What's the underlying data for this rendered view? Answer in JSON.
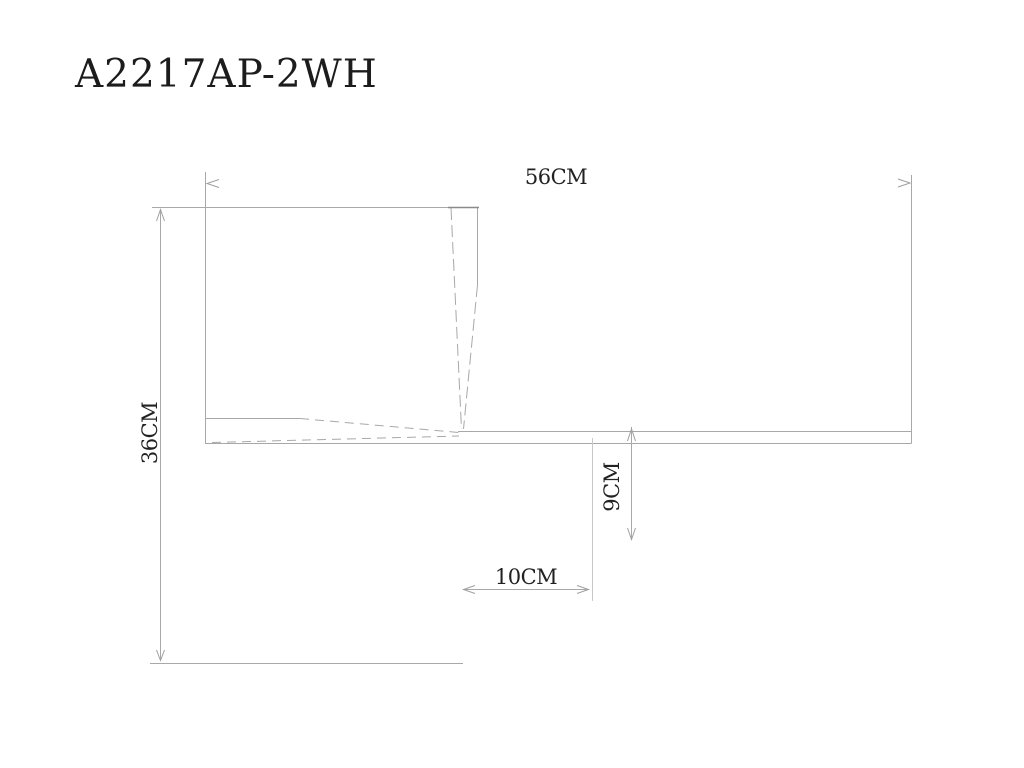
{
  "title": {
    "text": "A2217AP-2WH"
  },
  "drawing": {
    "product_code": "A2217AP-2WH",
    "dimensions": {
      "width_label": "56CM",
      "height_label": "36CM",
      "drop_label": "9CM",
      "offset_label": "10CM"
    },
    "colors": {
      "line": "#a8a8a8",
      "dark_line": "#8a8a8a",
      "faint_line": "#c9c9c9",
      "arrow": "#9f9f9f",
      "text": "#222222",
      "background": "#ffffff"
    }
  }
}
